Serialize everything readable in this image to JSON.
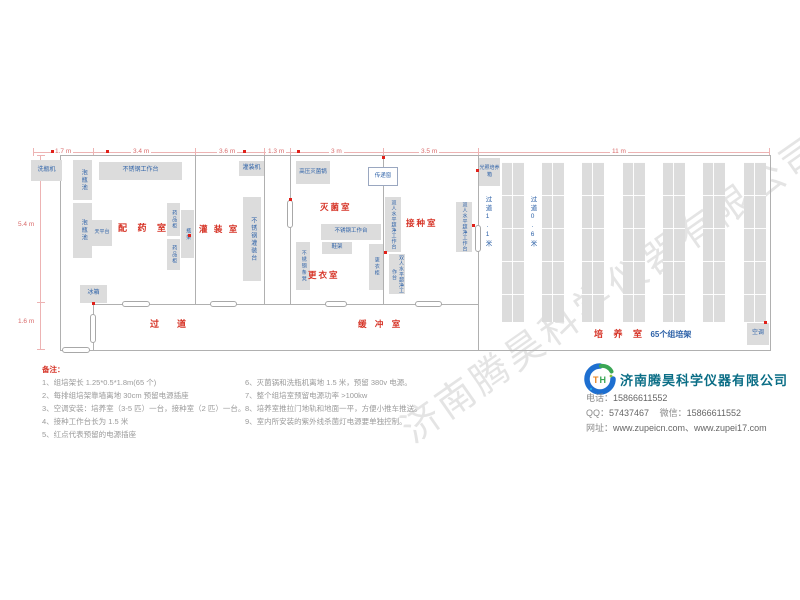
{
  "watermark": "济南腾昊科学仪器有限公司",
  "plan": {
    "dim_top": [
      "1.7 m",
      "3.4 m",
      "3.6 m",
      "1.3 m",
      "3 m",
      "3.5 m",
      "11 m"
    ],
    "dim_left": [
      "5.4 m",
      "1.6 m"
    ],
    "rooms": {
      "peiyao": "配 药 室",
      "guanzhuang": "灌 装 室",
      "miejun": "灭菌室",
      "gengyi": "更衣室",
      "jiezhong": "接种室",
      "guodao": "过　　道",
      "huanchong": "缓 冲 室",
      "peiyang": "培 养 室",
      "peiyang_sub": "65个组培架",
      "aisle_11": "过道1.1米",
      "aisle_06": "过道0.6米"
    },
    "equipment": {
      "xipingji": "洗瓶机",
      "paopingchi": "泡瓶池",
      "worktable": "不锈钢工作台",
      "tianpingtai": "天平台",
      "yaopingui": "药品柜",
      "pingjia": "瓶架",
      "guanzhuangji": "灌装机",
      "guanzhuangtai": "不锈钢灌装台",
      "bingxiang": "冰箱",
      "gaoya": "高压灭菌锅",
      "chuandichuang": "传递窗",
      "xiejia": "鞋架",
      "tiaodeng": "不锈钢条凳",
      "gengyigui": "更衣柜",
      "chaojing": "双人水平超净工作台",
      "guangzhao": "光照培养箱",
      "kongtiao": "空调"
    }
  },
  "notes": {
    "title": "备注：",
    "left": [
      "1、组培架长 1.25*0.5*1.8m(65 个)",
      "2、每排组培架靠墙离地 30cm 预留电源插座",
      "3、空调安装：培养室（3-5 匹）一台，接种室（2 匹）一台。",
      "4、接种工作台长为 1.5 米",
      "5、红点代表预留的电源插座"
    ],
    "right": [
      "6、灭菌锅和洗瓶机离地 1.5 米，预留 380v 电源。",
      "7、整个组培室预留电源功率 >100kw",
      "8、培养室推拉门地轨和地面一平，方便小推车推送。",
      "9、室内所安装的紫外线杀菌灯电源要单独控制。"
    ]
  },
  "company": {
    "name": "济南腾昊科学仪器有限公司",
    "phone_label": "电话：",
    "phone": "15866611552",
    "qq_label": "QQ：",
    "qq": "57437467",
    "wechat_label": "微信：",
    "wechat": "15866611552",
    "web_label": "网址：",
    "web": "www.zupeicn.com、www.zupei17.com"
  },
  "colors": {
    "room_red": "#d63427",
    "label_blue": "#2e62a8",
    "box_gray": "#dcdcdc",
    "company_teal": "#0b6e86",
    "socket_red": "#e0211a"
  }
}
